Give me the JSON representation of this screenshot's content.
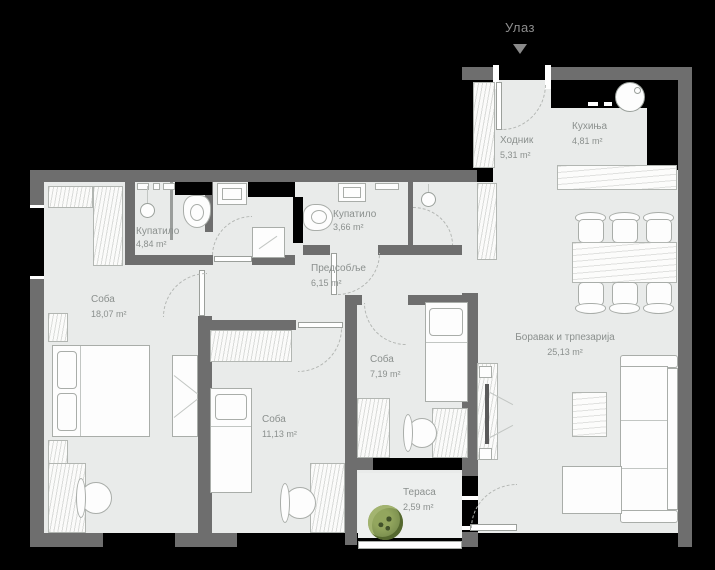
{
  "entrance": {
    "label": "Улаз"
  },
  "rooms": {
    "hodnik": {
      "name": "Ходник",
      "area": "5,31 m²"
    },
    "kuhinja": {
      "name": "Кухиња",
      "area": "4,81 m²"
    },
    "kupatilo1": {
      "name": "Купатило",
      "area": "4,84 m²"
    },
    "kupatilo2": {
      "name": "Купатило",
      "area": "3,66 m²"
    },
    "predsoblje": {
      "name": "Предсобље",
      "area": "6,15 m²"
    },
    "soba_velika": {
      "name": "Соба",
      "area": "18,07 m²"
    },
    "soba_mala": {
      "name": "Соба",
      "area": "7,19 m²"
    },
    "soba_srednja": {
      "name": "Соба",
      "area": "11,13 m²"
    },
    "boravak": {
      "name": "Боравак и трпезарија",
      "area": "25,13 m²"
    },
    "terasa": {
      "name": "Тераса",
      "area": "2,59 m²"
    }
  },
  "colors": {
    "wall": "#6e6e6e",
    "floor": "#e9ebea",
    "background": "#000000",
    "label": "#8b908e",
    "plant": "#7d9150"
  }
}
